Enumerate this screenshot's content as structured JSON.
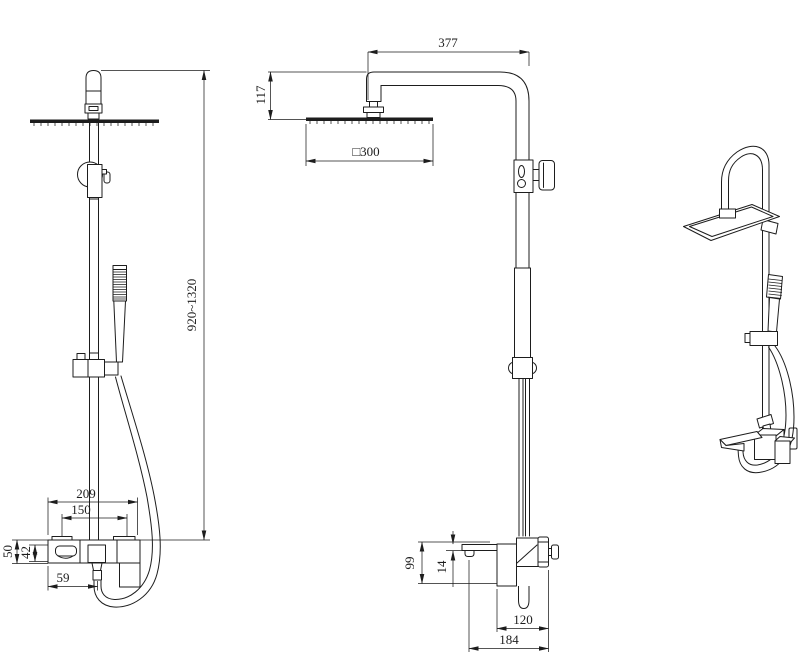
{
  "drawing": {
    "background": "#ffffff",
    "line_color": "#1d1d1d"
  },
  "dims": {
    "height_range": "920~1320",
    "overall_width": "209",
    "hole_spacing": "150",
    "body_height": "50",
    "body_inner_height": "42",
    "spout_offset": "59",
    "arm_reach": "377",
    "head_drop": "117",
    "head_size": "□300",
    "deck_height": "99",
    "spout_thickness": "14",
    "wall_to_body": "120",
    "wall_to_spout_tip": "184"
  }
}
